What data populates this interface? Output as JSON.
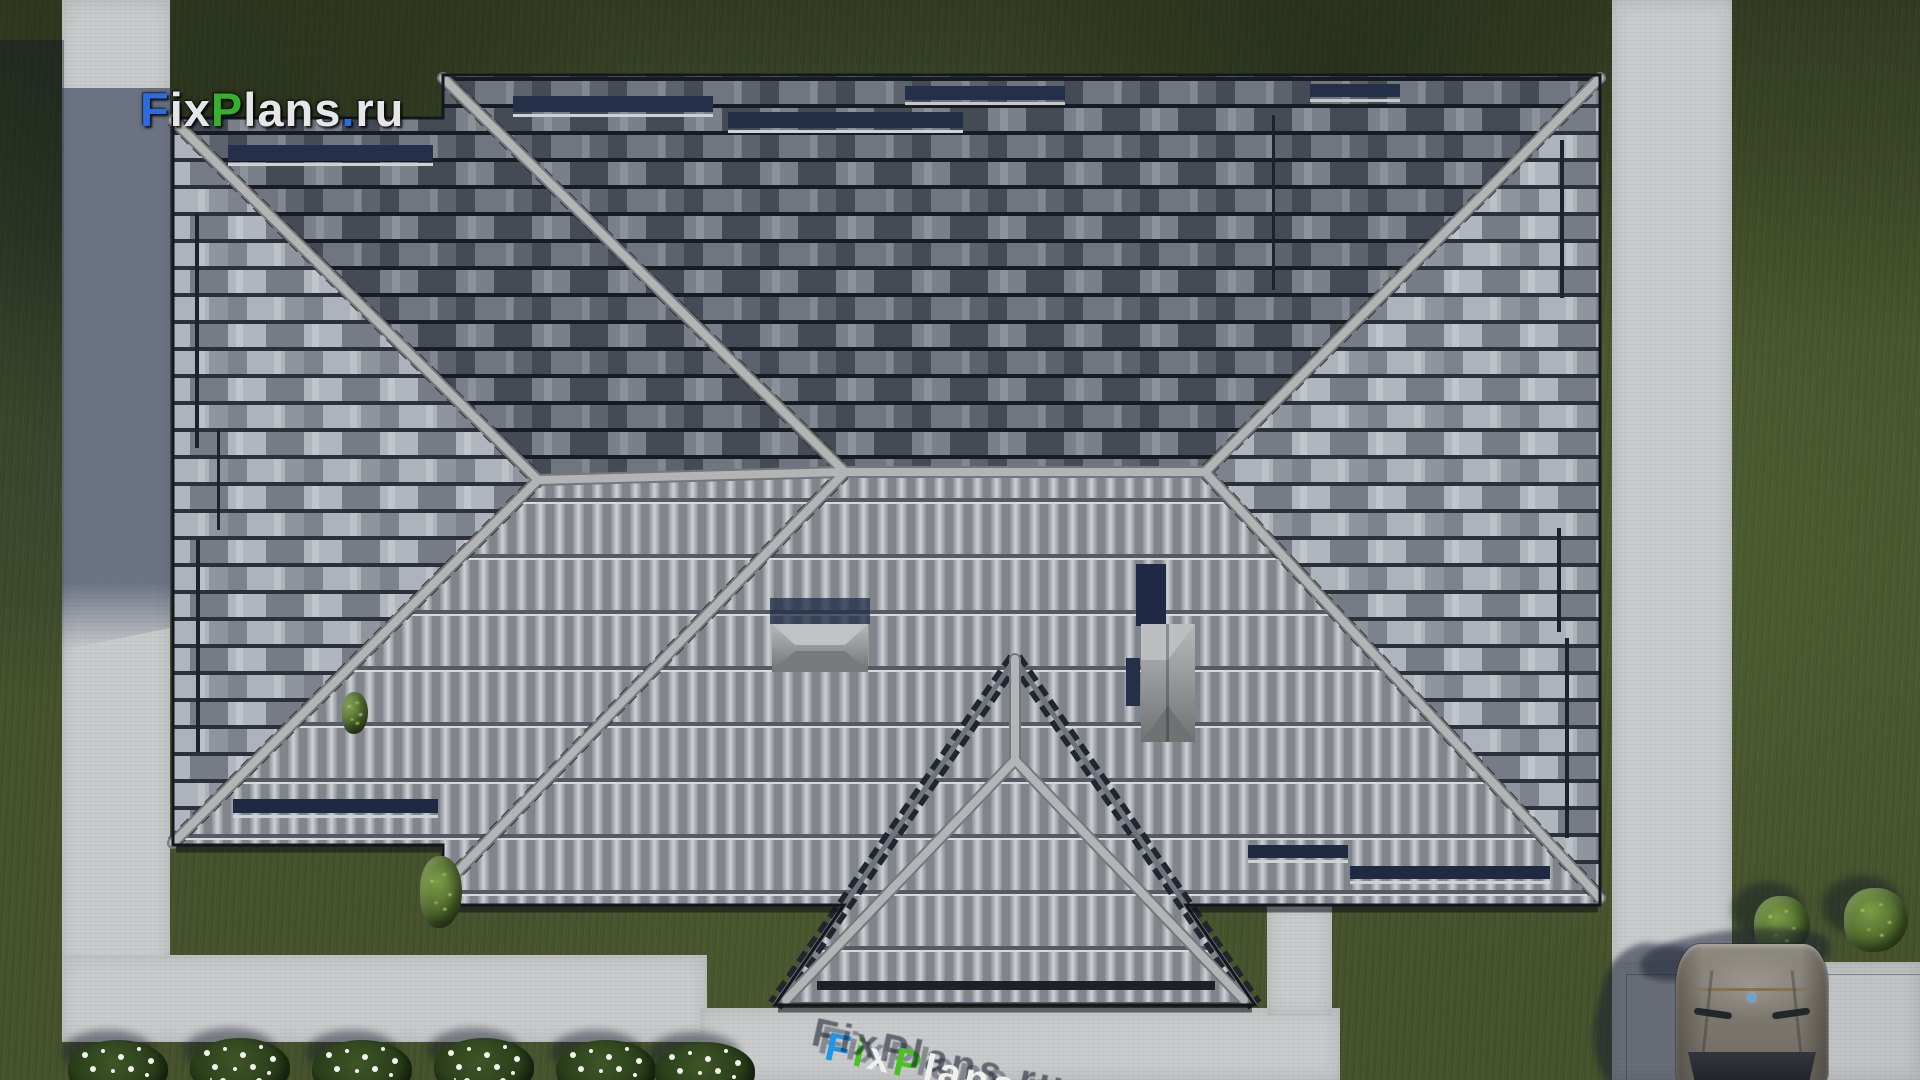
{
  "watermark": {
    "text": "FixPlans.ru",
    "parts": [
      {
        "text": "F",
        "color": "#2b6de0"
      },
      {
        "text": "ix",
        "color": "#e6e6e8"
      },
      {
        "text": "P",
        "color": "#35b12c"
      },
      {
        "text": "lans",
        "color": "#e6e6e8"
      },
      {
        "text": ".",
        "color": "#2b6de0"
      },
      {
        "text": "ru",
        "color": "#e6e6e8"
      }
    ]
  },
  "ground_text": {
    "text": "FixPlans.ru",
    "parts": [
      {
        "text": "F",
        "color": "#2196e8"
      },
      {
        "text": "i",
        "color": "#47c421"
      },
      {
        "text": "x",
        "color": "#f0f0ee"
      },
      {
        "text": "P",
        "color": "#47c421"
      },
      {
        "text": "lans",
        "color": "#f0f0ee"
      },
      {
        "text": ".",
        "color": "#2196e8"
      },
      {
        "text": "ru",
        "color": "#f0f0ee"
      }
    ]
  },
  "palette": {
    "grass": "#45522c",
    "grass-dark": "#2c3720",
    "grass-light": "#5a6a38",
    "concrete": "#c7c9cb",
    "concrete-shadow": "#3a4460",
    "roof-dark": "#4a505a",
    "roof-dark-tile": "#7d838d",
    "roof-med": "#868c96",
    "roof-med-tile": "#b0b6be",
    "rib-light": "#c4c8cc",
    "rib-gap": "#7b8087",
    "ridge": "#aeb0b2",
    "eave": "#171b21",
    "navy": "#243049",
    "car-body": "#6e6960",
    "car-glass": "#1f2228",
    "bush": "#4a6428",
    "flower": "#f2f2ee"
  }
}
